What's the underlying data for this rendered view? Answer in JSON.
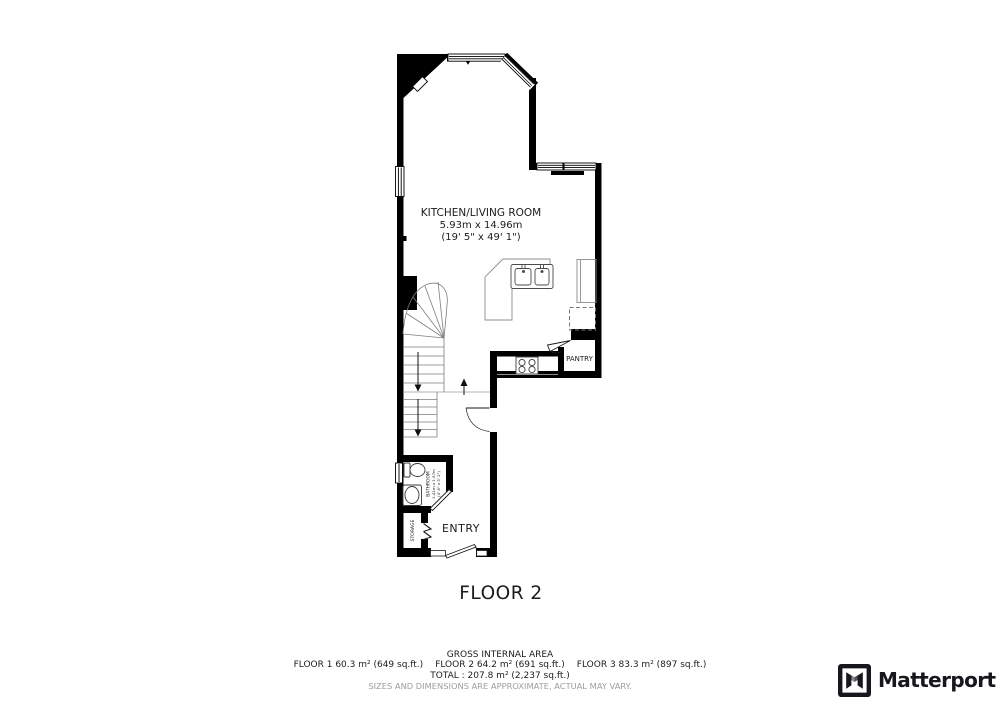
{
  "plan": {
    "floor_label": "FLOOR 2",
    "rooms": {
      "kitchen_living": {
        "name": "KITCHEN/LIVING ROOM",
        "dimensions_m": "5.93m x 14.96m",
        "dimensions_ft": "(19' 5\" x 49' 1\")"
      },
      "pantry": {
        "name": "PANTRY"
      },
      "bathroom": {
        "name": "BATHROOM",
        "dimensions_m": "1.41m x 1.57m",
        "dimensions_ft": "(4' 8\" x 5' 2\")"
      },
      "storage": {
        "name": "STORAGE"
      },
      "entry": {
        "name": "ENTRY"
      }
    }
  },
  "footer": {
    "gross_internal_area_title": "GROSS INTERNAL AREA",
    "floor_areas": [
      "FLOOR 1 60.3 m² (649 sq.ft.)",
      "FLOOR 2 64.2 m² (691 sq.ft.)",
      "FLOOR 3 83.3 m² (897 sq.ft.)"
    ],
    "total": "TOTAL :  207.8 m² (2,237 sq.ft.)",
    "disclaimer": "SIZES AND DIMENSIONS ARE APPROXIMATE, ACTUAL MAY VARY."
  },
  "branding": {
    "logo_text": "Matterport"
  },
  "colors": {
    "wall": "#000000",
    "text": "#1b1b1b",
    "muted": "#9d9d9d",
    "logo": "#17171d"
  }
}
